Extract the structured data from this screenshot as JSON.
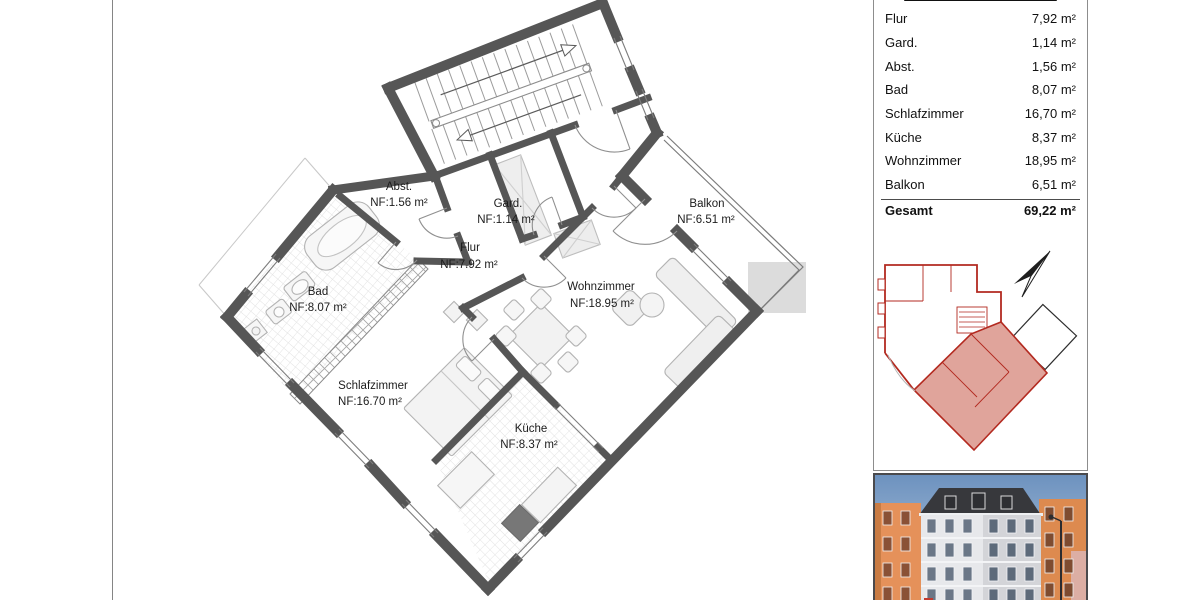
{
  "sidebar": {
    "title": "2. OBERGESCHOSS",
    "rows": [
      {
        "label": "Flur",
        "value": "7,92 m²"
      },
      {
        "label": "Gard.",
        "value": "1,14 m²"
      },
      {
        "label": "Abst.",
        "value": "1,56 m²"
      },
      {
        "label": "Bad",
        "value": "8,07 m²"
      },
      {
        "label": "Schlafzimmer",
        "value": "16,70 m²"
      },
      {
        "label": "Küche",
        "value": "8,37 m²"
      },
      {
        "label": "Wohnzimmer",
        "value": "18,95 m²"
      },
      {
        "label": "Balkon",
        "value": "6,51 m²"
      }
    ],
    "total": {
      "label": "Gesamt",
      "value": "69,22 m²"
    }
  },
  "plan": {
    "rooms": [
      {
        "name": "Abst.",
        "area": "NF:1.56 m²"
      },
      {
        "name": "Gard.",
        "area": "NF:1.14 m²"
      },
      {
        "name": "Flur",
        "area": "NF:7.92 m²"
      },
      {
        "name": "Bad",
        "area": "NF:8.07 m²"
      },
      {
        "name": "Schlafzimmer",
        "area": "NF:16.70 m²"
      },
      {
        "name": "Wohnzimmer",
        "area": "NF:18.95 m²"
      },
      {
        "name": "Küche",
        "area": "NF:8.37 m²"
      },
      {
        "name": "Balkon",
        "area": "NF:6.51 m²"
      }
    ]
  },
  "colors": {
    "wall": "#565656",
    "minimap_red": "#b32a20",
    "minimap_highlight": "#e0a49b",
    "photo_sky": "#6d92bf"
  },
  "icons": {
    "north_arrow": "north-arrow"
  }
}
